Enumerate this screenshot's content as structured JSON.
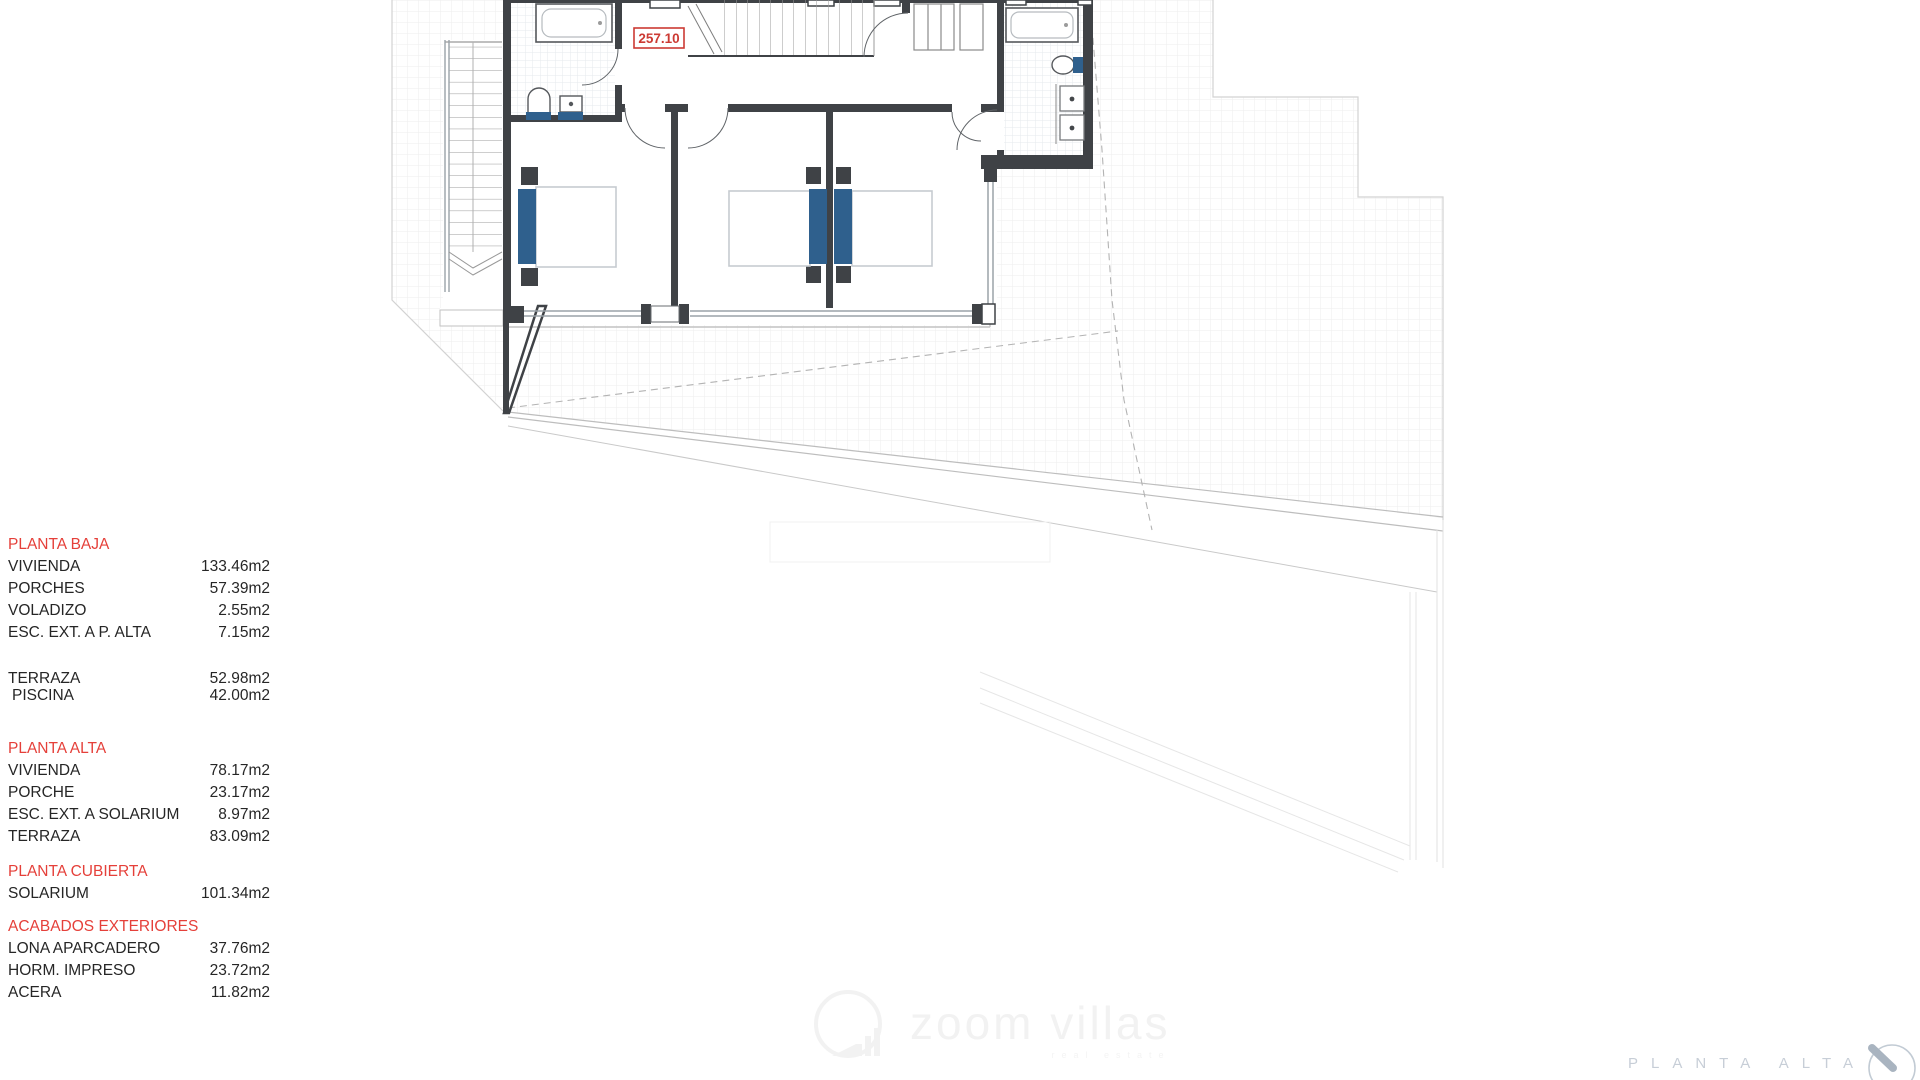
{
  "plan_label": {
    "value": "257.10"
  },
  "legend": {
    "sections": [
      {
        "header": "PLANTA BAJA",
        "gap_before": 0,
        "items": [
          {
            "label": "VIVIENDA",
            "value": "133.46m2"
          },
          {
            "label": "PORCHES",
            "value": "57.39m2"
          },
          {
            "label": "VOLADIZO",
            "value": "2.55m2"
          },
          {
            "label": "ESC. EXT. A P. ALTA",
            "value": "7.15m2"
          }
        ]
      },
      {
        "header": "",
        "gap_before": 26,
        "row_gap": 17,
        "items": [
          {
            "label": "TERRAZA",
            "value": "52.98m2"
          },
          {
            "label": "PISCINA",
            "value": "42.00m2",
            "indent": true
          }
        ]
      },
      {
        "header": "PLANTA ALTA",
        "gap_before": 34,
        "items": [
          {
            "label": "VIVIENDA",
            "value": "78.17m2"
          },
          {
            "label": "PORCHE",
            "value": "23.17m2"
          },
          {
            "label": "ESC. EXT. A SOLARIUM",
            "value": "8.97m2"
          },
          {
            "label": "TERRAZA",
            "value": "83.09m2"
          }
        ]
      },
      {
        "header": "PLANTA CUBIERTA",
        "gap_before": 13,
        "items": [
          {
            "label": "SOLARIUM",
            "value": "101.34m2"
          }
        ]
      },
      {
        "header": "ACABADOS EXTERIORES",
        "gap_before": 11,
        "items": [
          {
            "label": "LONA APARCADERO",
            "value": "37.76m2"
          },
          {
            "label": "HORM. IMPRESO",
            "value": "23.72m2"
          },
          {
            "label": "ACERA",
            "value": "11.82m2"
          }
        ]
      }
    ]
  },
  "watermark": {
    "brand": "zoom villas",
    "tagline": "real estate",
    "logo_icon": "zoom-villas-logo-icon"
  },
  "footer": {
    "sheet_title": "PLANTA ALTA",
    "compass_icon": "compass-needle-icon"
  },
  "colors": {
    "legend_header_red": "#e5403a",
    "plan_label_red": "#cc3a33",
    "fixture_blue": "#2f608d",
    "wall_dark": "#3f4246",
    "sheet_title_gray": "#c7ced7"
  }
}
